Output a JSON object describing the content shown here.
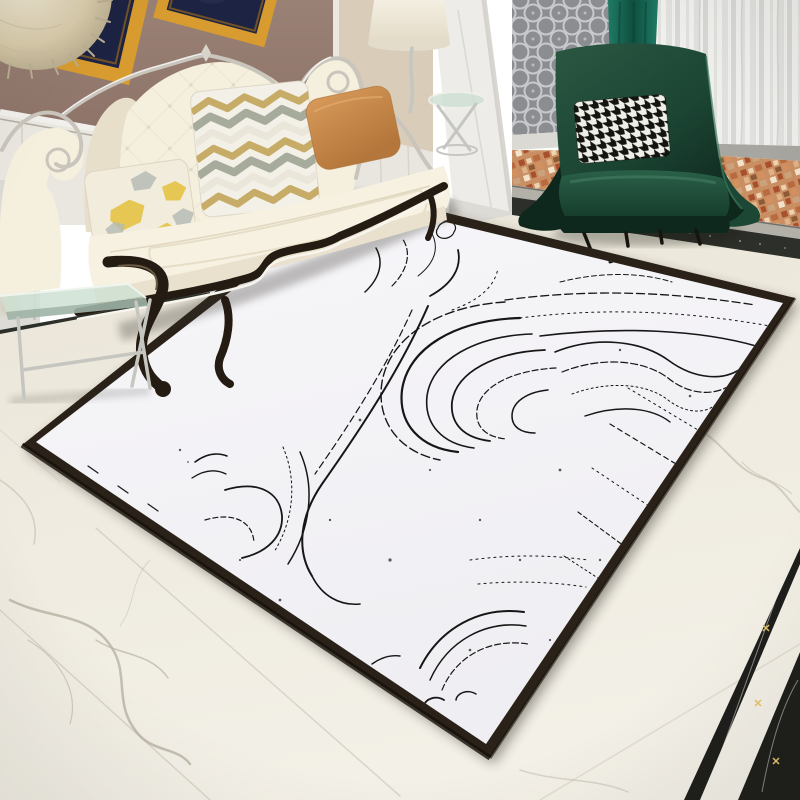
{
  "meta": {
    "type": "product-lifestyle-photo",
    "description": "Luxury living room scene showcasing a white area rug with black marble-ink swirl pattern and dark border, on ivory marble flooring",
    "visible_text": "none"
  },
  "objects": {
    "rug": {
      "name": "area-rug",
      "pattern": "abstract black ink marble swirls",
      "background": "white",
      "border": "dark brown"
    },
    "sofa": {
      "name": "baroque-tufted-sofa",
      "upholstery": "cream",
      "frame": "white carved crest with dark wood scroll legs",
      "pillows": [
        "yellow-grey abstract print",
        "sage-gold chevron leaf",
        "solid ochre"
      ]
    },
    "armchair": {
      "name": "wingback-armchair",
      "upholstery": "dark emerald green",
      "pillow": "black-white houndstooth",
      "legs": "thin black metal"
    },
    "wall": {
      "finish": "mauve paint over white wainscot",
      "art": [
        "gold-frame-artwork-left",
        "gold-frame-artwork-right"
      ],
      "decor": "fluffy dried-bloom sphere"
    },
    "partition": {
      "column": "white pilaster",
      "screen": "grey quatrefoil lattice panel"
    },
    "window": {
      "curtains": [
        "sheer white-grey stripes",
        "teal accent drape"
      ]
    },
    "balcony": {
      "floor": "terracotta mosaic tile",
      "threshold": "grey stone sill with black marble band"
    },
    "floor": {
      "main": "ivory marble tiles with grey veining",
      "inlay": "black marble border strips with gold flecks"
    },
    "tables": [
      "glass-console-table-left",
      "glass-side-table-right"
    ],
    "lighting": [
      "floor-lamp-cream-shade"
    ]
  },
  "colors": {
    "wall-mauve": "#9a8176",
    "wall-mauve-dark": "#8a7064",
    "wainscot-white": "#eae7e0",
    "trim-shadow": "#b2ada3",
    "frame-gold": "#d79b2f",
    "frame-gold-deep": "#a86f18",
    "art-navy": "#1d2342",
    "fluff-tan": "#d8cbab",
    "fluff-light": "#f2ecdb",
    "hall-beige": "#d9cdb9",
    "column-white": "#edece8",
    "column-shade": "#cfccc5",
    "screen-gray": "#8b8d91",
    "screen-lattice": "#c7c9cc",
    "divider-white": "#e3e2de",
    "curtain-light": "#efefed",
    "curtain-stripe": "#d3d3d0",
    "curtain-teal": "#1f7b66",
    "curtain-teal-dark": "#0f4f3f",
    "under-curtain-gray": "#a7a6a0",
    "mosaic-base": "#c98f63",
    "sill-stone": "#b3b0a8",
    "band-dark": "#2d302a",
    "floor-ivory": "#efebe0",
    "floor-warm": "#e9e4d6",
    "seam-gray": "#d5d0c3",
    "vein-gray": "#b9b2a2",
    "inlay-black": "#1d1e1b",
    "inlay-vein": "#efece3",
    "gold-fleck": "#e3c468",
    "rug-white": "#f4f3f6",
    "rug-border": "#2a2219",
    "rug-ink": "#161616",
    "sofa-cream": "#f5efde",
    "sofa-cream-deep": "#e7dfc9",
    "sofa-shade": "#d9d0b8",
    "sofa-wood": "#241b12",
    "piping-white": "#f7f5ed",
    "silver-trim": "#c9c5bc",
    "pillow-print-base": "#f1ecdc",
    "pillow-yellow": "#e5c13d",
    "pillow-gray": "#b5bab4",
    "chevron-base": "#f3f0e7",
    "chevron-gold": "#c7ac67",
    "chevron-sage": "#a6ab9c",
    "pillow-orange": "#cf9254",
    "pillow-orange-dark": "#b4763a",
    "chair-green": "#1c4534",
    "chair-green-dark": "#0e281d",
    "chair-green-light": "#3c7a5c",
    "seat-green": "#1d4c39",
    "hound-black": "#141410",
    "hound-white": "#efefe8",
    "chrome": "#c6c6c1",
    "leg-black": "#17140e",
    "glass-teal": "#cfe0d4",
    "glass-edge": "#9fb4a6",
    "shade-cream": "#efe9da"
  }
}
